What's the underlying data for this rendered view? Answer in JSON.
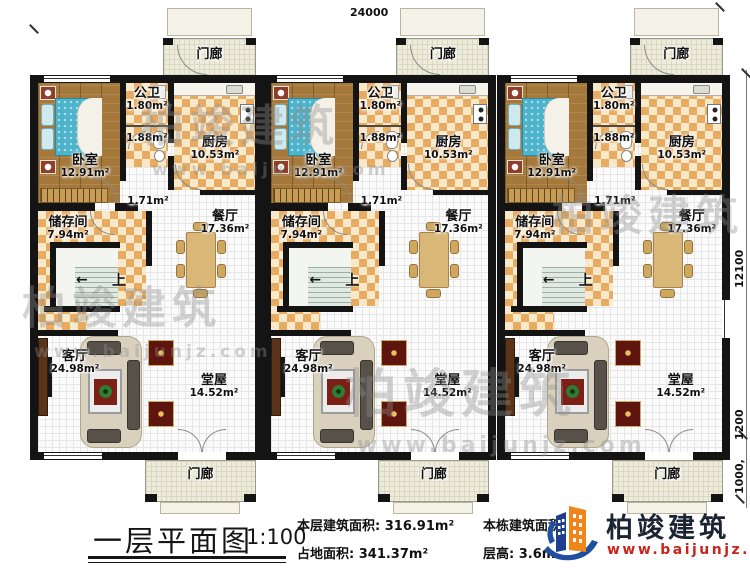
{
  "units_count": 3,
  "dimensions": {
    "top_width": "24000",
    "right_height": "12100",
    "right_lower": "1200",
    "right_porch": "1000,"
  },
  "unit": {
    "rooms": {
      "porch_top": "门廊",
      "bedroom": {
        "name": "卧室",
        "area": "12.91m²"
      },
      "toilet": {
        "name": "公卫",
        "area": "1.80m²"
      },
      "bath": {
        "area": "1.88m²"
      },
      "hall": {
        "area": "1.71m²"
      },
      "kitchen": {
        "name": "厨房",
        "area": "10.53m²"
      },
      "storage": {
        "name": "储存间",
        "area": "7.94m²"
      },
      "dining": {
        "name": "餐厅",
        "area": "17.36m²"
      },
      "stairs_up": "上",
      "stairs_arrow": "←",
      "living": {
        "name": "客厅",
        "area": "24.98m²"
      },
      "main_hall": {
        "name": "堂屋",
        "area": "14.52m²"
      },
      "porch_bottom": "门廊"
    }
  },
  "watermark": {
    "text": "柏竣建筑",
    "url": "www.baijunjz.com"
  },
  "title_block": {
    "title": "一层平面图",
    "scale": "1:100",
    "stats": [
      {
        "label": "本层建筑面积:",
        "value": "316.91m²"
      },
      {
        "label": "占地面积:",
        "value": "341.37m²"
      },
      {
        "label": "本栋建筑面积:",
        "value": ""
      },
      {
        "label": "层高:",
        "value": "3.6m"
      }
    ],
    "logo": {
      "name": "柏竣建筑",
      "url": "www.baijunjz.com"
    }
  }
}
